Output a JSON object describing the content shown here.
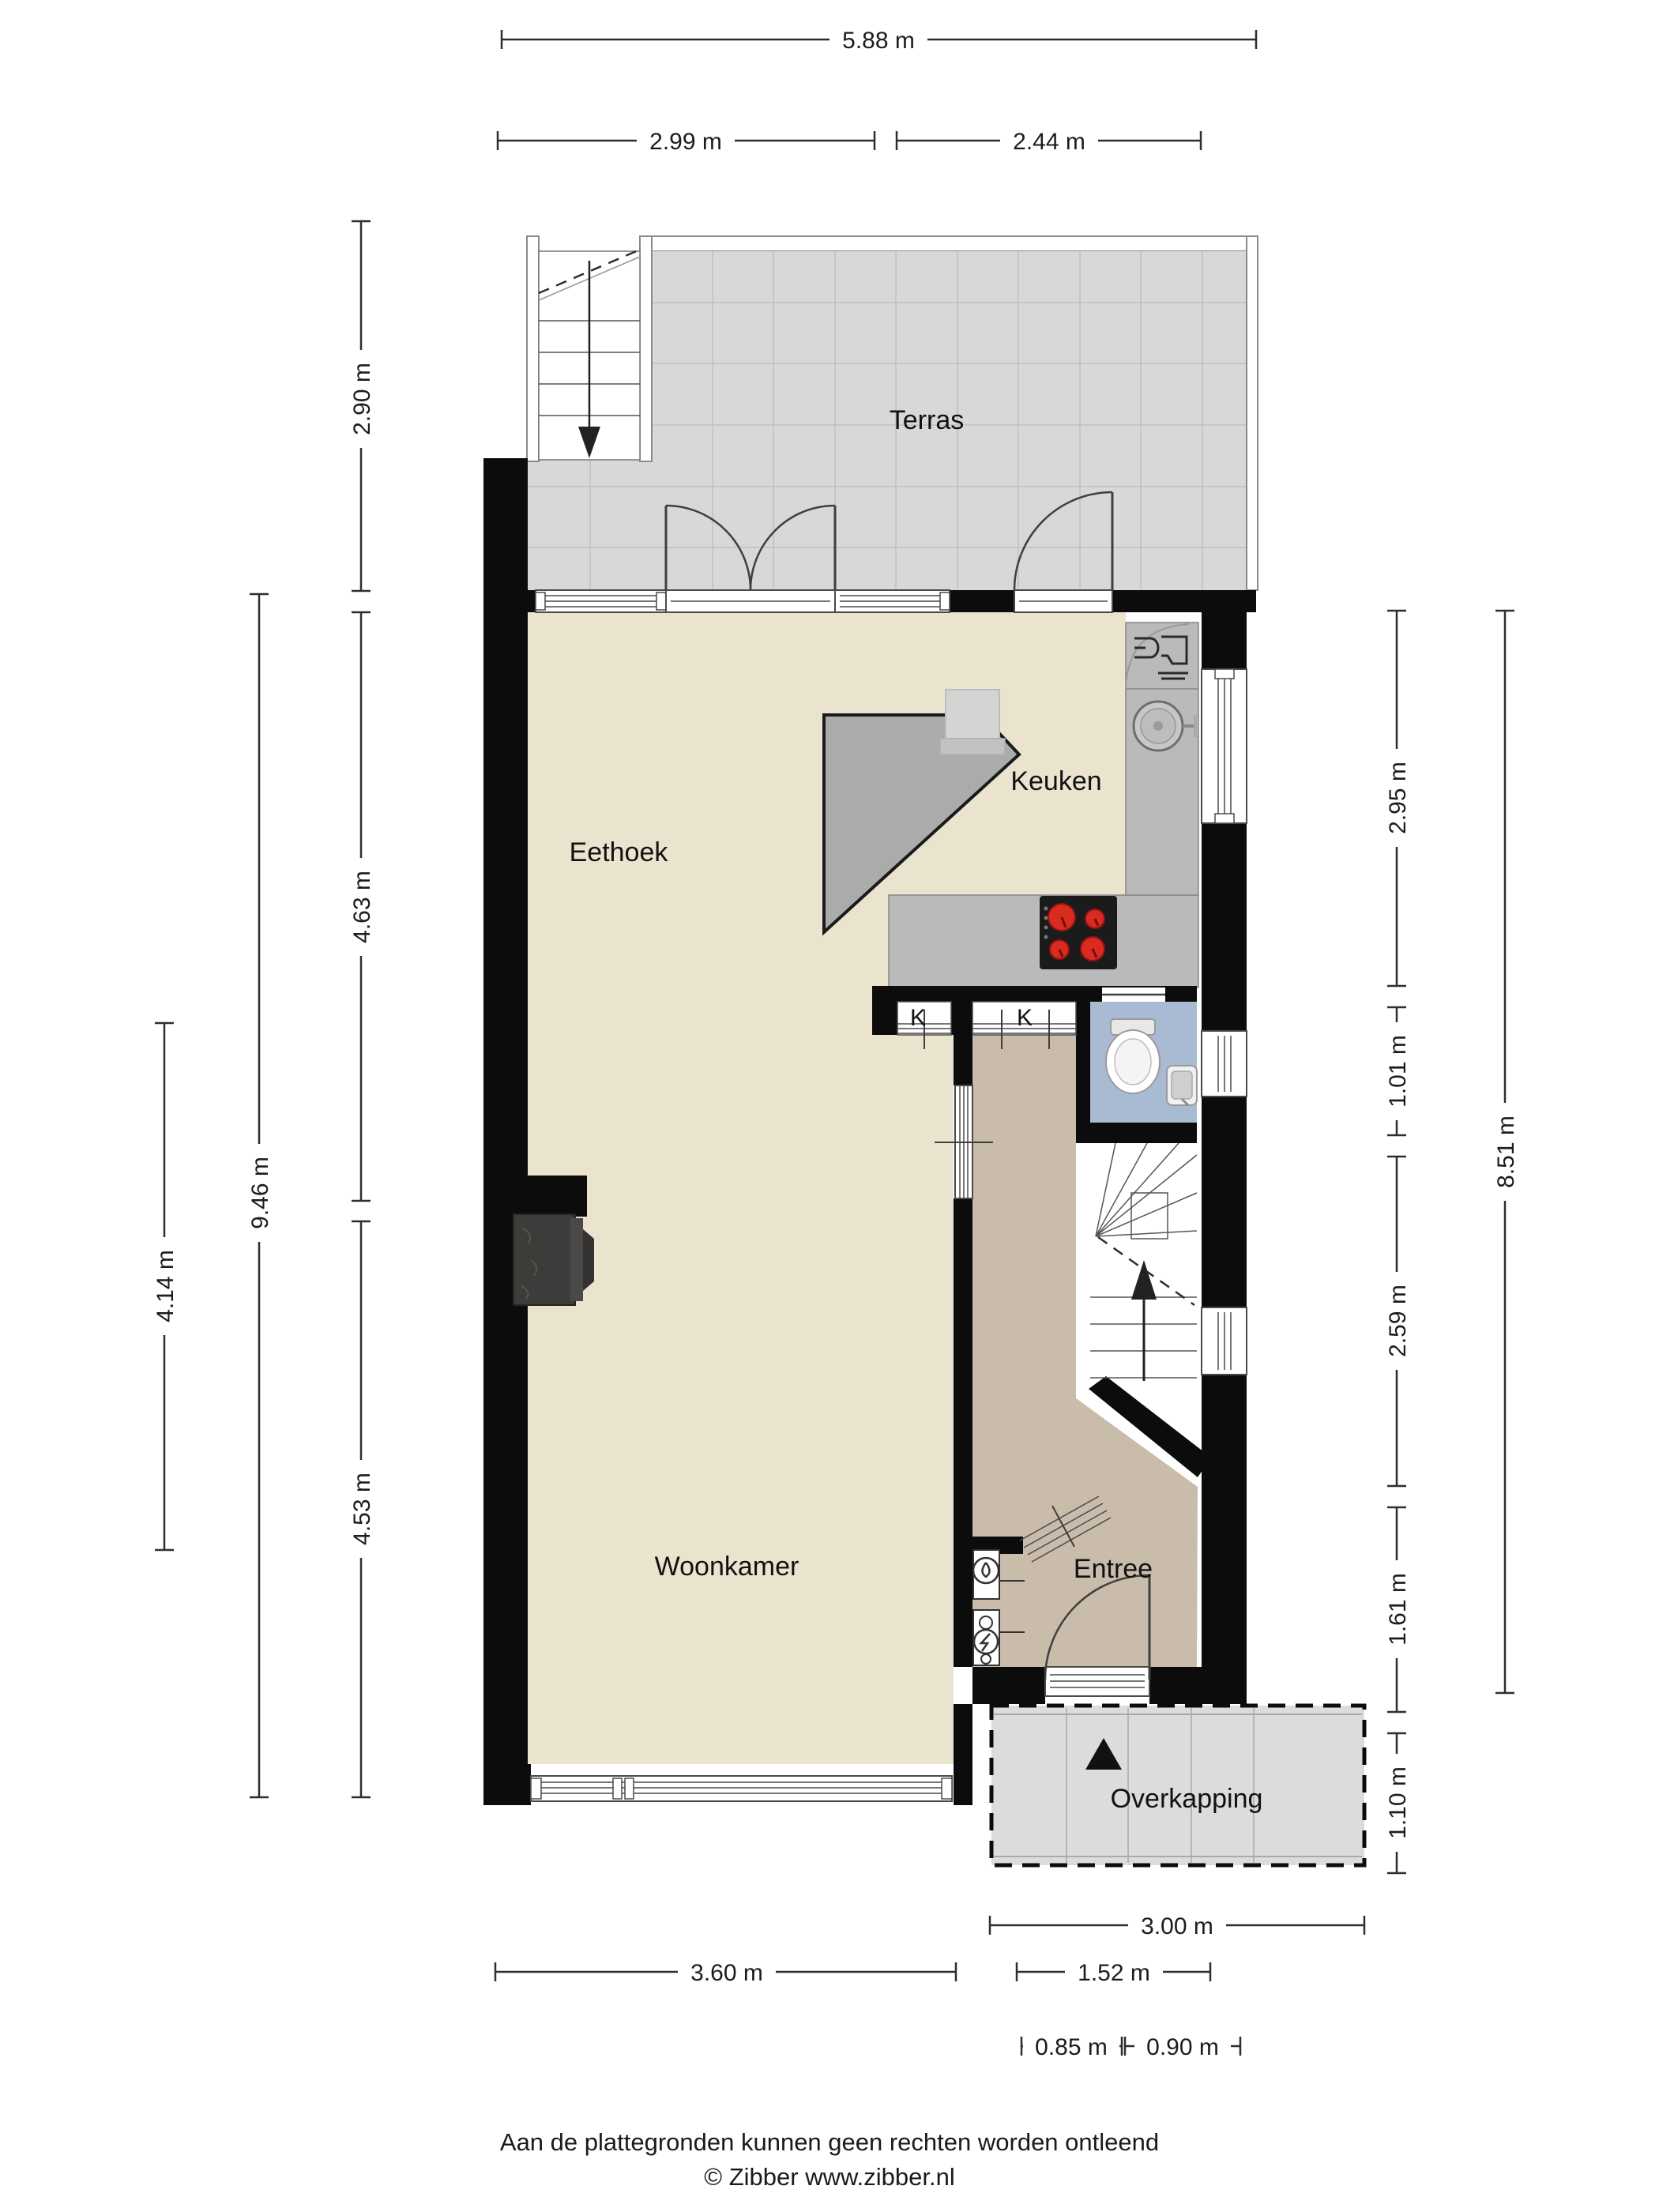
{
  "plan": {
    "rooms": {
      "terras": "Terras",
      "eethoek": "Eethoek",
      "keuken": "Keuken",
      "woonkamer": "Woonkamer",
      "entree": "Entree",
      "overkapping": "Overkapping",
      "closet_left": "K",
      "closet_right": "K"
    },
    "dimensions": {
      "width_total": "5.88 m",
      "width_left": "2.99 m",
      "width_right": "2.44 m",
      "terras_depth": "2.90 m",
      "eethoek_depth": "4.63 m",
      "woonkamer_depth": "4.53 m",
      "interior_depth": "9.46 m",
      "woonkamer_mid": "4.14 m",
      "keuken_depth": "2.95 m",
      "toilet_depth": "1.01 m",
      "stairs_depth": "2.59 m",
      "entree_depth": "1.61 m",
      "overkapping_depth": "1.10 m",
      "right_total": "8.51 m",
      "woonkamer_width": "3.60 m",
      "entree_width": "1.52 m",
      "front_door_width": "0.85 m",
      "front_door_side": "0.90 m",
      "overkapping_width": "3.00 m"
    },
    "colors": {
      "wall": "#0c0c0c",
      "floor_interior": "#eae4cf",
      "floor_hall": "#c9bcab",
      "floor_toilet": "#a8bbd2",
      "floor_terras": "#d8d8d8",
      "counter": "#bababa",
      "burner_red": "#d92b20",
      "fireplace": "#3d3c3a"
    },
    "icons": {
      "north_arrow": "triangle-up",
      "stairs_down_arrow": "arrow-down",
      "stairs_up_arrow": "arrow-up",
      "water_meter": "circle-droplet",
      "electric_meter": "circle-lightning",
      "sink": "round-basin",
      "dishwasher": "glass-and-fork",
      "cooktop": "four-burners"
    }
  },
  "footer": {
    "disclaimer": "Aan de plattegronden kunnen geen rechten worden ontleend",
    "copyright": "© Zibber www.zibber.nl"
  }
}
